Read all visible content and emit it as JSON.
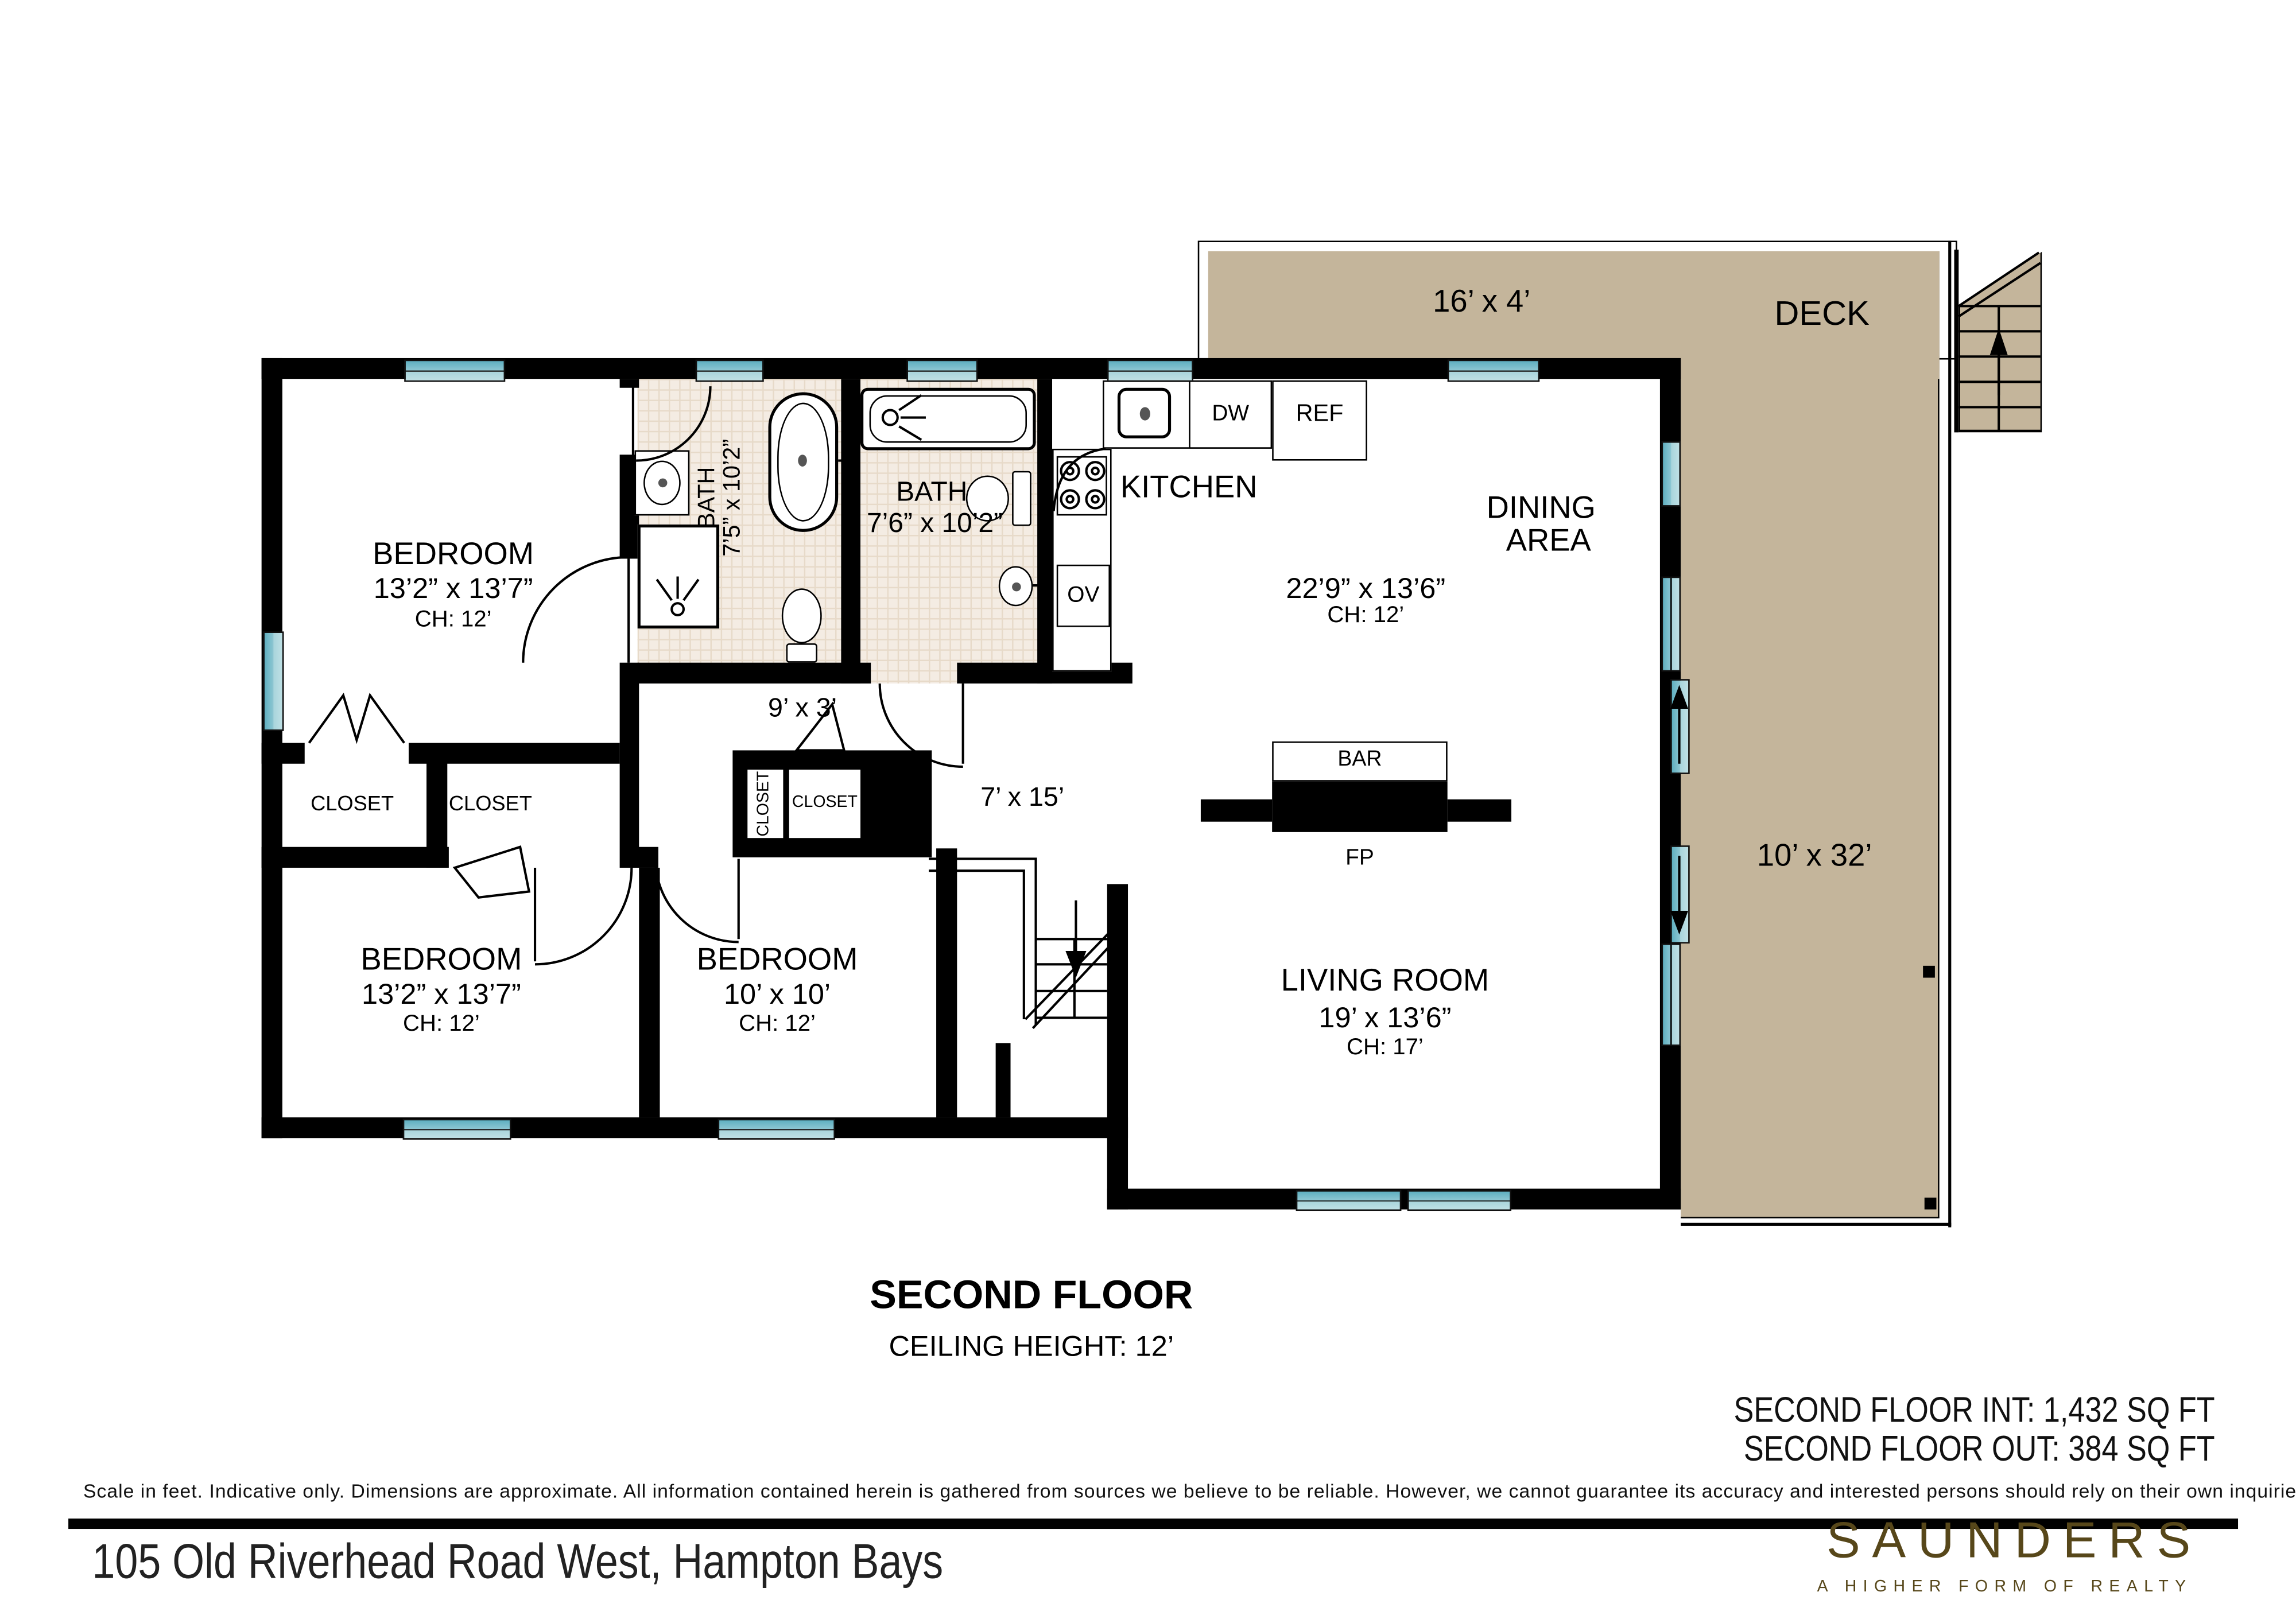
{
  "colors": {
    "wall": "#000000",
    "window_teal": "#74bcca",
    "deck_tan": "#c4b59b",
    "tile_beige": "#f4ece3",
    "brand_brown": "#57471a"
  },
  "deck": {
    "top_dims": "16’ x 4’",
    "name": "DECK",
    "side_dims": "10’ x 32’"
  },
  "kitchen": {
    "name": "KITCHEN",
    "dishwasher": "DW",
    "refrigerator": "REF",
    "oven": "OV"
  },
  "dining": {
    "name_line1": "DINING",
    "name_line2": "AREA",
    "dims": "22’9” x 13’6”",
    "ceiling": "CH: 12’"
  },
  "bath1": {
    "name": "BATH",
    "dims": "7’5” x 10’2”"
  },
  "bath2": {
    "name": "BATH",
    "dims": "7’6” x 10’2”"
  },
  "bedroom1": {
    "name": "BEDROOM",
    "dims": "13’2” x 13’7”",
    "ceiling": "CH: 12’"
  },
  "bedroom2": {
    "name": "BEDROOM",
    "dims": "13’2” x 13’7”",
    "ceiling": "CH: 12’"
  },
  "bedroom3": {
    "name": "BEDROOM",
    "dims": "10’ x 10’",
    "ceiling": "CH: 12’"
  },
  "living": {
    "name": "LIVING ROOM",
    "dims": "19’ x 13’6”",
    "ceiling": "CH: 17’"
  },
  "halls": {
    "hall1": "9’ x 3’",
    "hall2": "7’ x 15’"
  },
  "closets": {
    "c1": "CLOSET",
    "c2": "CLOSET",
    "c3": "CLOSET",
    "c4": "CLOSET"
  },
  "fireplace": {
    "bar": "BAR",
    "fp": "FP"
  },
  "footer": {
    "title": "SECOND FLOOR",
    "ceiling": "CEILING HEIGHT: 12’",
    "int_sqft": "SECOND FLOOR INT: 1,432 SQ FT",
    "out_sqft": "SECOND FLOOR OUT: 384 SQ FT",
    "disclaimer": "Scale in feet. Indicative only. Dimensions are approximate. All information contained herein is gathered from sources we believe to be reliable. However, we cannot guarantee its accuracy and interested persons should rely on their own inquiries .",
    "address": "105 Old Riverhead Road West, Hampton Bays"
  },
  "branding": {
    "logo": "SAUNDERS",
    "tagline": "A HIGHER FORM OF REALTY"
  }
}
